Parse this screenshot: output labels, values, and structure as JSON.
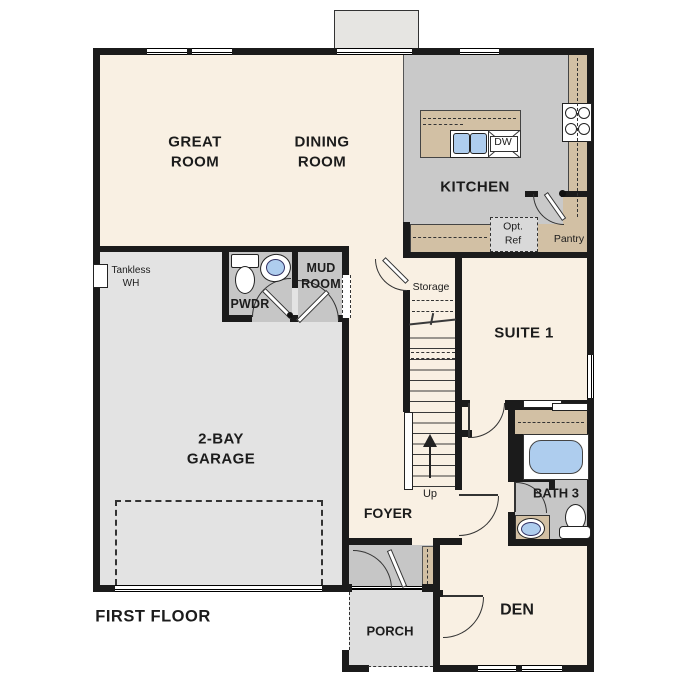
{
  "plan": {
    "title": "FIRST FLOOR",
    "rooms": {
      "great_room": "GREAT ROOM",
      "dining_room": "DINING ROOM",
      "kitchen": "KITCHEN",
      "suite_1": "SUITE 1",
      "garage": "2-BAY GARAGE",
      "powder": "PWDR",
      "mud_room": "MUD ROOM",
      "bath_3": "BATH 3",
      "foyer": "FOYER",
      "den": "DEN",
      "porch": "PORCH",
      "pantry": "Pantry",
      "storage": "Storage"
    },
    "annotations": {
      "up": "Up",
      "opt_ref": "Opt. Ref",
      "dishwasher": "DW",
      "tankless": "Tankless WH"
    },
    "colors": {
      "wall": "#1b1b1b",
      "line": "#333333",
      "cream": "#f9f0e3",
      "kitchen": "#c9c9c9",
      "service": "#c6c6c6",
      "garage": "#e3e3e3",
      "porch": "#dedede",
      "tan": "#d2c0a4",
      "blue": "#aecdee",
      "bump": "#e6e5e2",
      "optref": "#d9d9d9"
    }
  }
}
